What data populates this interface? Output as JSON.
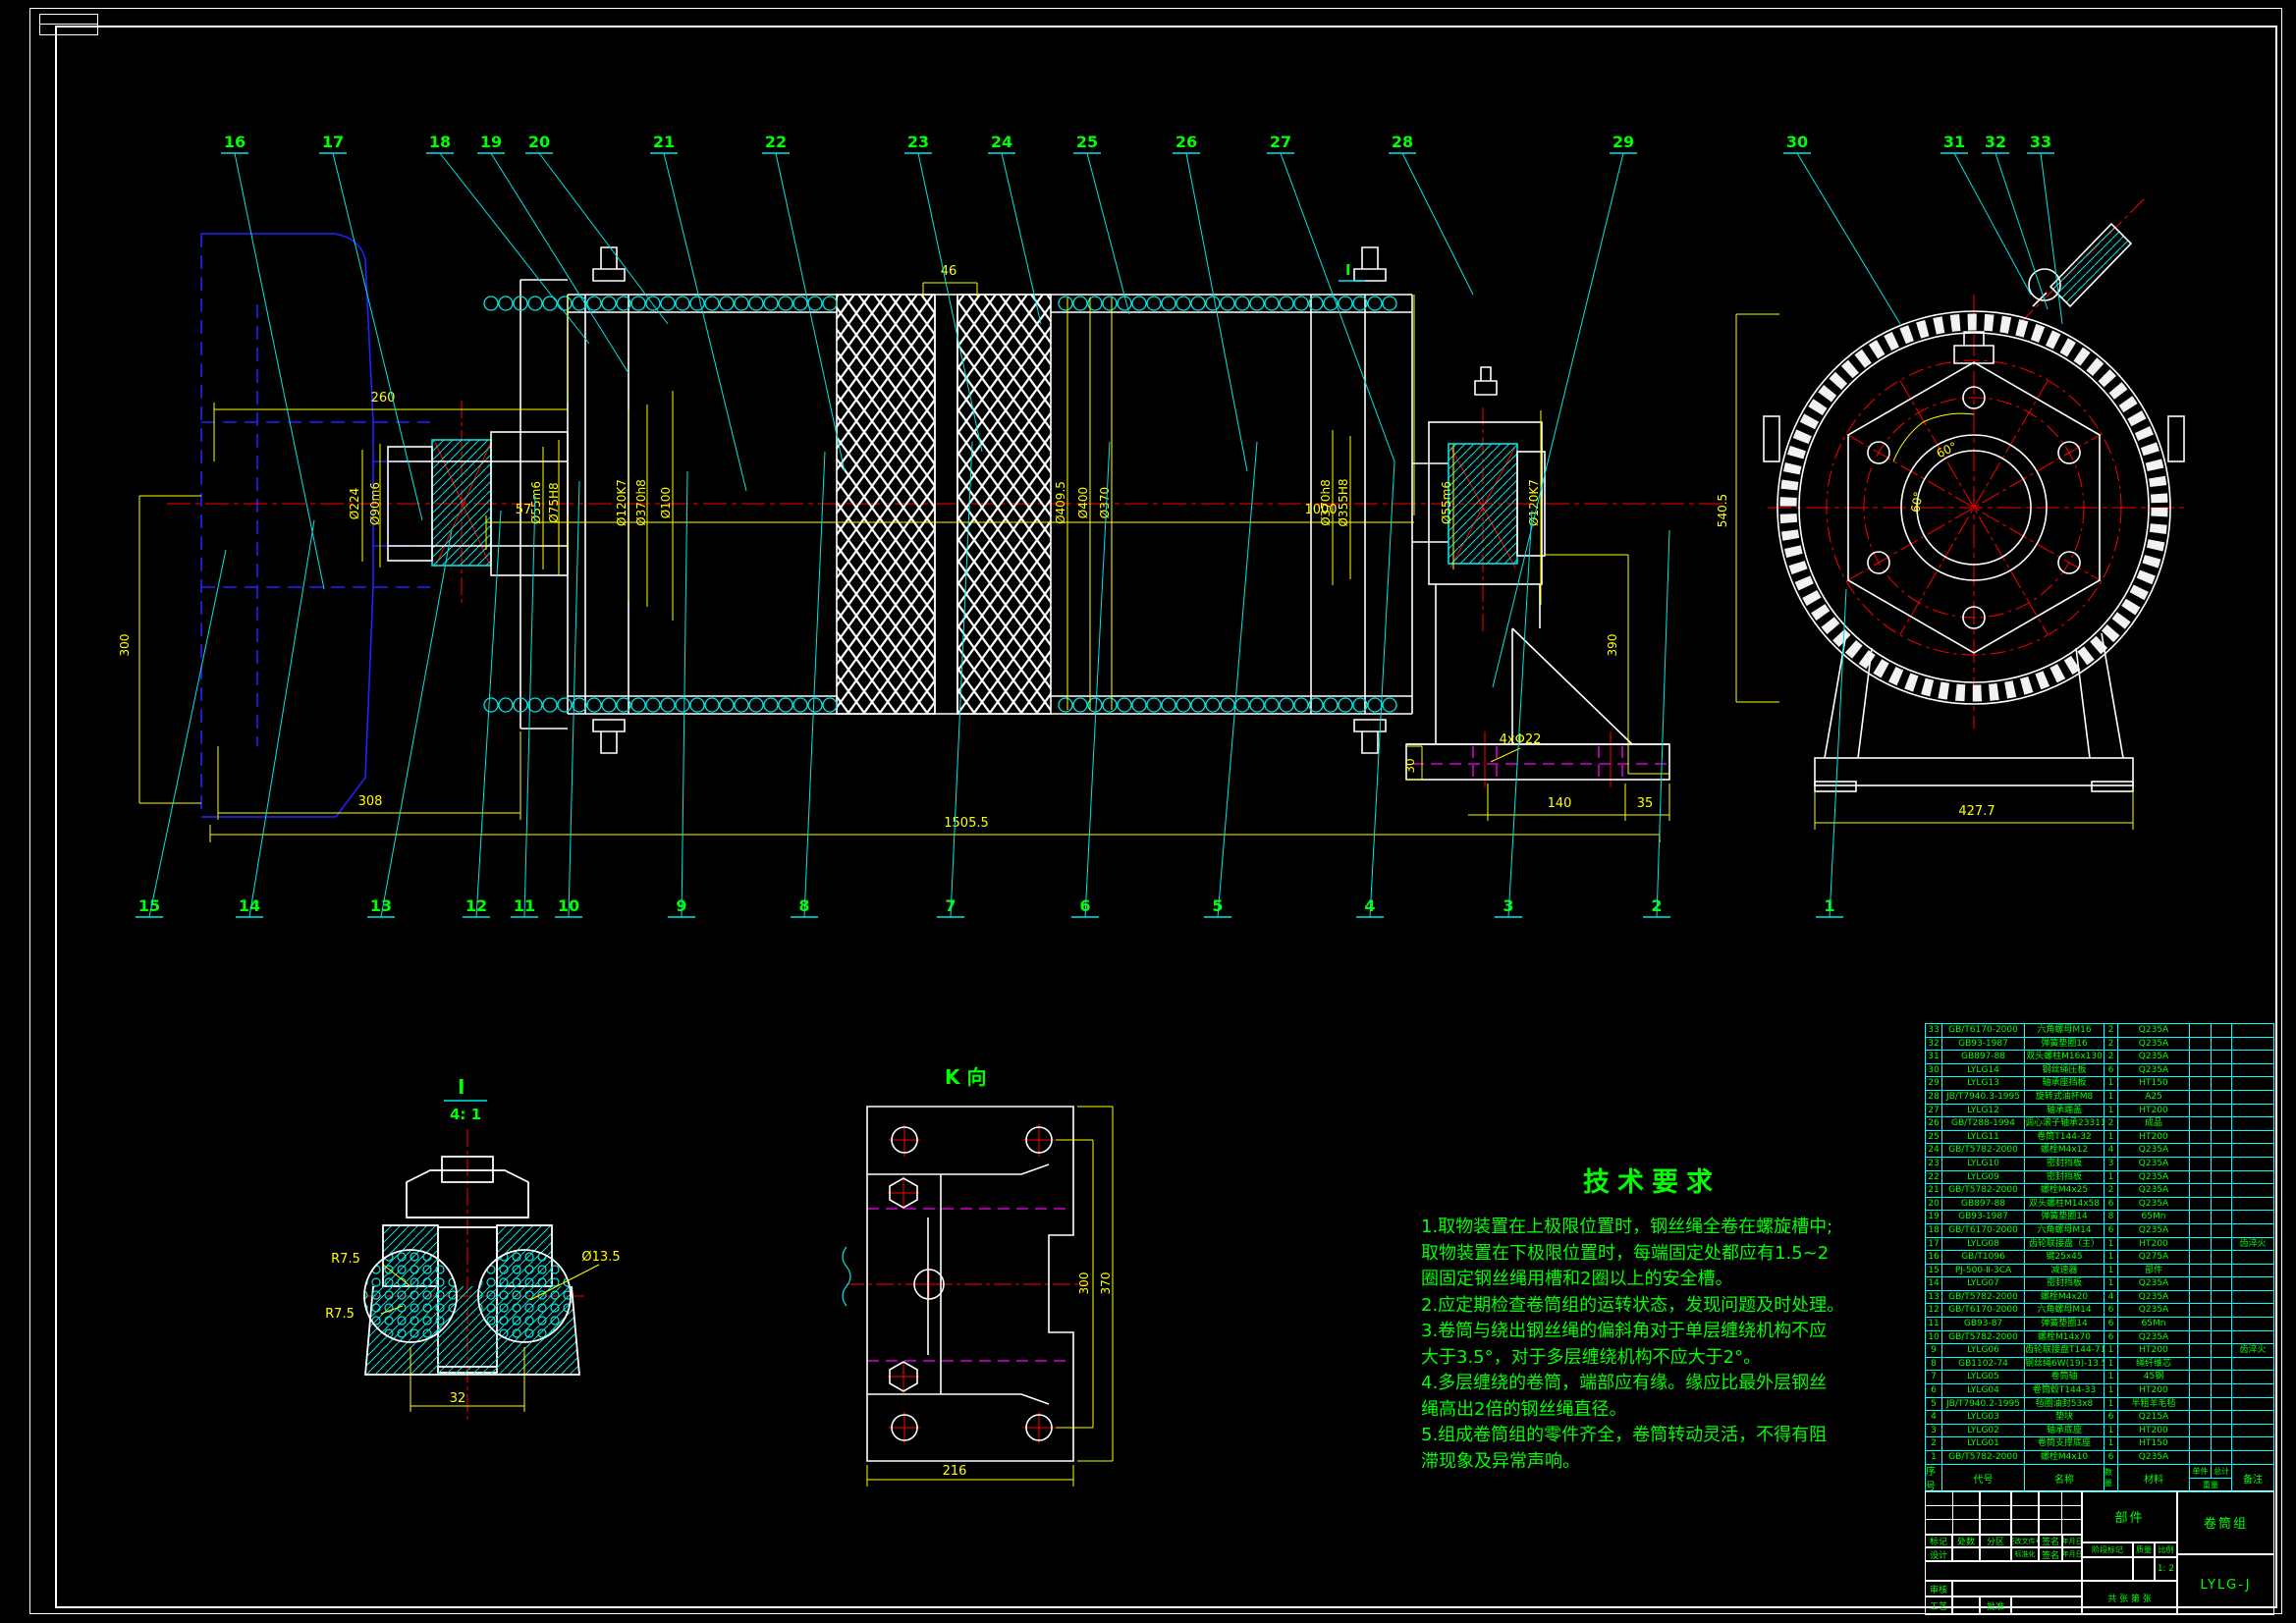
{
  "drawing": {
    "background": "#000000",
    "accent_colors": {
      "geometry": "#ffffff",
      "dimension": "#ffff00",
      "annotation": "#00ff00",
      "hatch_leader": "#00ffff",
      "centerline": "#ff0000",
      "hidden": "#ff00ff",
      "phantom": "#2222ff"
    }
  },
  "balloons": {
    "top": [
      "16",
      "17",
      "18",
      "19",
      "20",
      "21",
      "22",
      "23",
      "24",
      "25",
      "26",
      "27",
      "28",
      "29",
      "30",
      "31",
      "32",
      "33"
    ],
    "bottom": [
      "15",
      "14",
      "13",
      "12",
      "11",
      "10",
      "9",
      "8",
      "7",
      "6",
      "5",
      "4",
      "3",
      "2",
      "1"
    ]
  },
  "views": {
    "detail_label": "I",
    "detail_scale": "4: 1",
    "detail_ref_marker": "I",
    "k_view_label": "K 向"
  },
  "dimensions": {
    "len260": "260",
    "len57": "57",
    "len1000": "1000",
    "len46": "46",
    "len300": "300",
    "len308": "308",
    "len1505": "1505.5",
    "len390": "390",
    "len540": "540.5",
    "len427": "427.7",
    "len140": "140",
    "len35": "35",
    "len30": "30",
    "holes22": "4xΦ22",
    "dia224": "Ø224",
    "dia90": "Ø90m6",
    "dia55L": "Ø55m6",
    "dia75": "Ø75H8",
    "dia120L": "Ø120K7",
    "dia370f": "Ø370h8",
    "dia100": "Ø100",
    "dia409": "Ø409.5",
    "dia400": "Ø400",
    "dia370": "Ø370",
    "dia370R": "Ø370h8",
    "dia355": "Ø355H8",
    "dia55R": "Ø55m6",
    "dia120R": "Ø120K7",
    "ang60a": "60°",
    "ang60b": "60°",
    "r75a": "R7.5",
    "r75b": "R7.5",
    "dia135": "Ø13.5",
    "len32": "32",
    "len216": "216",
    "len300k": "300",
    "len370k": "370"
  },
  "tech_requirements": {
    "title": "技术要求",
    "lines": [
      "1.取物装置在上极限位置时，钢丝绳全卷在螺旋槽中;",
      "取物装置在下极限位置时，每端固定处都应有1.5~2",
      "圈固定钢丝绳用槽和2圈以上的安全槽。",
      "2.应定期检查卷筒组的运转状态，发现问题及时处理。",
      "3.卷筒与绕出钢丝绳的偏斜角对于单层缠绕机构不应",
      "大于3.5°，对于多层缠绕机构不应大于2°。",
      "4.多层缠绕的卷筒，端部应有缘。缘应比最外层钢丝",
      "绳高出2倍的钢丝绳直径。",
      "5.组成卷筒组的零件齐全，卷筒转动灵活，不得有阻",
      "滞现象及异常声响。"
    ]
  },
  "bom": {
    "headers": {
      "no": "序号",
      "code": "代号",
      "name": "名称",
      "qty": "数量",
      "material": "材料",
      "unit": "单件",
      "total": "总计",
      "weight": "重量",
      "remark": "备注"
    },
    "rows": [
      {
        "no": "33",
        "code": "GB/T6170-2000",
        "name": "六角螺母M16",
        "qty": "2",
        "material": "Q235A",
        "remark": ""
      },
      {
        "no": "32",
        "code": "GB93-1987",
        "name": "弹簧垫圈16",
        "qty": "2",
        "material": "Q235A",
        "remark": ""
      },
      {
        "no": "31",
        "code": "GB897-88",
        "name": "双头螺柱M16x130",
        "qty": "2",
        "material": "Q235A",
        "remark": ""
      },
      {
        "no": "30",
        "code": "LYLG14",
        "name": "钢丝绳压板",
        "qty": "6",
        "material": "Q235A",
        "remark": ""
      },
      {
        "no": "29",
        "code": "LYLG13",
        "name": "轴承座挡板",
        "qty": "1",
        "material": "HT150",
        "remark": ""
      },
      {
        "no": "28",
        "code": "JB/T7940.3-1995",
        "name": "旋转式油杯M8",
        "qty": "1",
        "material": "A25",
        "remark": ""
      },
      {
        "no": "27",
        "code": "LYLG12",
        "name": "轴承端盖",
        "qty": "1",
        "material": "HT200",
        "remark": ""
      },
      {
        "no": "26",
        "code": "GB/T288-1994",
        "name": "调心滚子轴承23311",
        "qty": "2",
        "material": "成品",
        "remark": ""
      },
      {
        "no": "25",
        "code": "LYLG11",
        "name": "卷筒T144-32",
        "qty": "1",
        "material": "HT200",
        "remark": ""
      },
      {
        "no": "24",
        "code": "GB/T5782-2000",
        "name": "螺栓M4x12",
        "qty": "4",
        "material": "Q235A",
        "remark": ""
      },
      {
        "no": "23",
        "code": "LYLG10",
        "name": "密封挡板",
        "qty": "3",
        "material": "Q235A",
        "remark": ""
      },
      {
        "no": "22",
        "code": "LYLG09",
        "name": "密封挡板",
        "qty": "1",
        "material": "Q235A",
        "remark": ""
      },
      {
        "no": "21",
        "code": "GB/T5782-2000",
        "name": "螺栓M4x25",
        "qty": "2",
        "material": "Q235A",
        "remark": ""
      },
      {
        "no": "20",
        "code": "GB897-88",
        "name": "双头螺柱M14x58",
        "qty": "6",
        "material": "Q235A",
        "remark": ""
      },
      {
        "no": "19",
        "code": "GB93-1987",
        "name": "弹簧垫圈14",
        "qty": "8",
        "material": "65Mn",
        "remark": ""
      },
      {
        "no": "18",
        "code": "GB/T6170-2000",
        "name": "六角螺母M14",
        "qty": "6",
        "material": "Q235A",
        "remark": ""
      },
      {
        "no": "17",
        "code": "LYLG08",
        "name": "齿轮联接盘（主）",
        "qty": "1",
        "material": "HT200",
        "remark": "齿淬火"
      },
      {
        "no": "16",
        "code": "GB/T1096",
        "name": "键25x45",
        "qty": "1",
        "material": "Q275A",
        "remark": ""
      },
      {
        "no": "15",
        "code": "PJ-500-Ⅱ-3CA",
        "name": "减速器",
        "qty": "1",
        "material": "部件",
        "remark": ""
      },
      {
        "no": "14",
        "code": "LYLG07",
        "name": "密封挡板",
        "qty": "1",
        "material": "Q235A",
        "remark": ""
      },
      {
        "no": "13",
        "code": "GB/T5782-2000",
        "name": "螺栓M4x20",
        "qty": "4",
        "material": "Q235A",
        "remark": ""
      },
      {
        "no": "12",
        "code": "GB/T6170-2000",
        "name": "六角螺母M14",
        "qty": "6",
        "material": "Q235A",
        "remark": ""
      },
      {
        "no": "11",
        "code": "GB93-87",
        "name": "弹簧垫圈14",
        "qty": "6",
        "material": "65Mn",
        "remark": ""
      },
      {
        "no": "10",
        "code": "GB/T5782-2000",
        "name": "螺栓M14x70",
        "qty": "6",
        "material": "Q235A",
        "remark": ""
      },
      {
        "no": "9",
        "code": "LYLG06",
        "name": "齿轮联接盘T144-71（从）",
        "qty": "1",
        "material": "HT200",
        "remark": "齿淬火"
      },
      {
        "no": "8",
        "code": "GB1102-74",
        "name": "钢丝绳6W(19)-13.5",
        "qty": "1",
        "material": "绳纤维芯",
        "remark": ""
      },
      {
        "no": "7",
        "code": "LYLG05",
        "name": "卷筒轴",
        "qty": "1",
        "material": "45钢",
        "remark": ""
      },
      {
        "no": "6",
        "code": "LYLG04",
        "name": "卷筒毂T144-33",
        "qty": "1",
        "material": "HT200",
        "remark": ""
      },
      {
        "no": "5",
        "code": "JB/T7940.2-1995",
        "name": "毡圈油封53x8",
        "qty": "1",
        "material": "半粗羊毛毡",
        "remark": ""
      },
      {
        "no": "4",
        "code": "LYLG03",
        "name": "垫块",
        "qty": "6",
        "material": "Q215A",
        "remark": ""
      },
      {
        "no": "3",
        "code": "LYLG02",
        "name": "轴承底座",
        "qty": "1",
        "material": "HT200",
        "remark": ""
      },
      {
        "no": "2",
        "code": "LYLG01",
        "name": "卷筒支撑底座",
        "qty": "1",
        "material": "HT150",
        "remark": ""
      },
      {
        "no": "1",
        "code": "GB/T5782-2000",
        "name": "螺栓M4x10",
        "qty": "6",
        "material": "Q235A",
        "remark": ""
      }
    ]
  },
  "title_block": {
    "part_type": "部件",
    "product_name": "卷筒组",
    "drawing_code": "LYLG-J",
    "scale_value": "1: 2",
    "labels": {
      "mark": "标记",
      "count": "处数",
      "zone": "分区",
      "change_file": "更改文件号",
      "sign": "签名",
      "date": "年月日",
      "design": "设计",
      "standard": "标准化",
      "stage_mark": "阶段标记",
      "weight": "质量",
      "scale": "比例",
      "audit": "审核",
      "process": "工艺",
      "approve": "批准",
      "sheets": "共 张 第 张"
    }
  }
}
